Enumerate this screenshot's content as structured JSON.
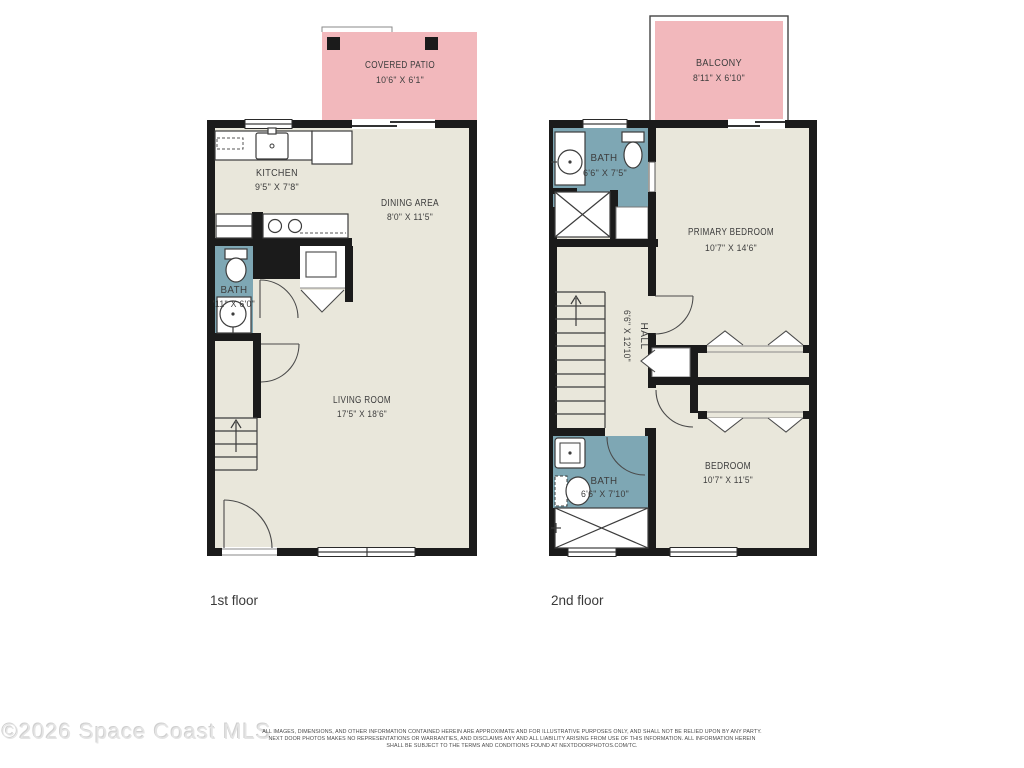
{
  "floors": [
    {
      "label": "1st floor",
      "rooms": [
        {
          "name": "COVERED PATIO",
          "dims": "10'6\" X 6'1\""
        },
        {
          "name": "KITCHEN",
          "dims": "9'5\" X 7'8\""
        },
        {
          "name": "DINING AREA",
          "dims": "8'0\" X 11'5\""
        },
        {
          "name": "BATH",
          "dims": "'11\" X 6'0\""
        },
        {
          "name": "LIVING ROOM",
          "dims": "17'5\" X 18'6\""
        }
      ]
    },
    {
      "label": "2nd floor",
      "rooms": [
        {
          "name": "BALCONY",
          "dims": "8'11\" X 6'10\""
        },
        {
          "name": "BATH",
          "dims": "6'6\" X 7'5\""
        },
        {
          "name": "PRIMARY BEDROOM",
          "dims": "10'7\" X 14'6\""
        },
        {
          "name": "HALL",
          "dims": "6'6\" X 12'10\""
        },
        {
          "name": "BATH",
          "dims": "6'6\" X 7'10\""
        },
        {
          "name": "BEDROOM",
          "dims": "10'7\" X 11'5\""
        }
      ]
    }
  ],
  "watermark": "©2026 Space Coast MLS",
  "disclaimer": {
    "line1": "ALL IMAGES, DIMENSIONS, AND OTHER INFORMATION CONTAINED HEREIN ARE APPROXIMATE AND FOR ILLUSTRATIVE PURPOSES ONLY, AND SHALL NOT BE RELIED UPON BY ANY PARTY.",
    "line2": "NEXT DOOR PHOTOS MAKES NO REPRESENTATIONS OR WARRANTIES, AND DISCLAIMS ANY AND ALL LIABILITY ARISING FROM USE OF THIS INFORMATION. ALL INFORMATION HEREIN",
    "line3": "SHALL BE SUBJECT TO THE TERMS AND CONDITIONS FOUND AT NEXTDOORPHOTOS.COM/TC."
  },
  "colors": {
    "wall": "#1b1b1b",
    "floor": "#e9e7db",
    "bath": "#7ea7b4",
    "outdoor": "#f2b8bc"
  }
}
